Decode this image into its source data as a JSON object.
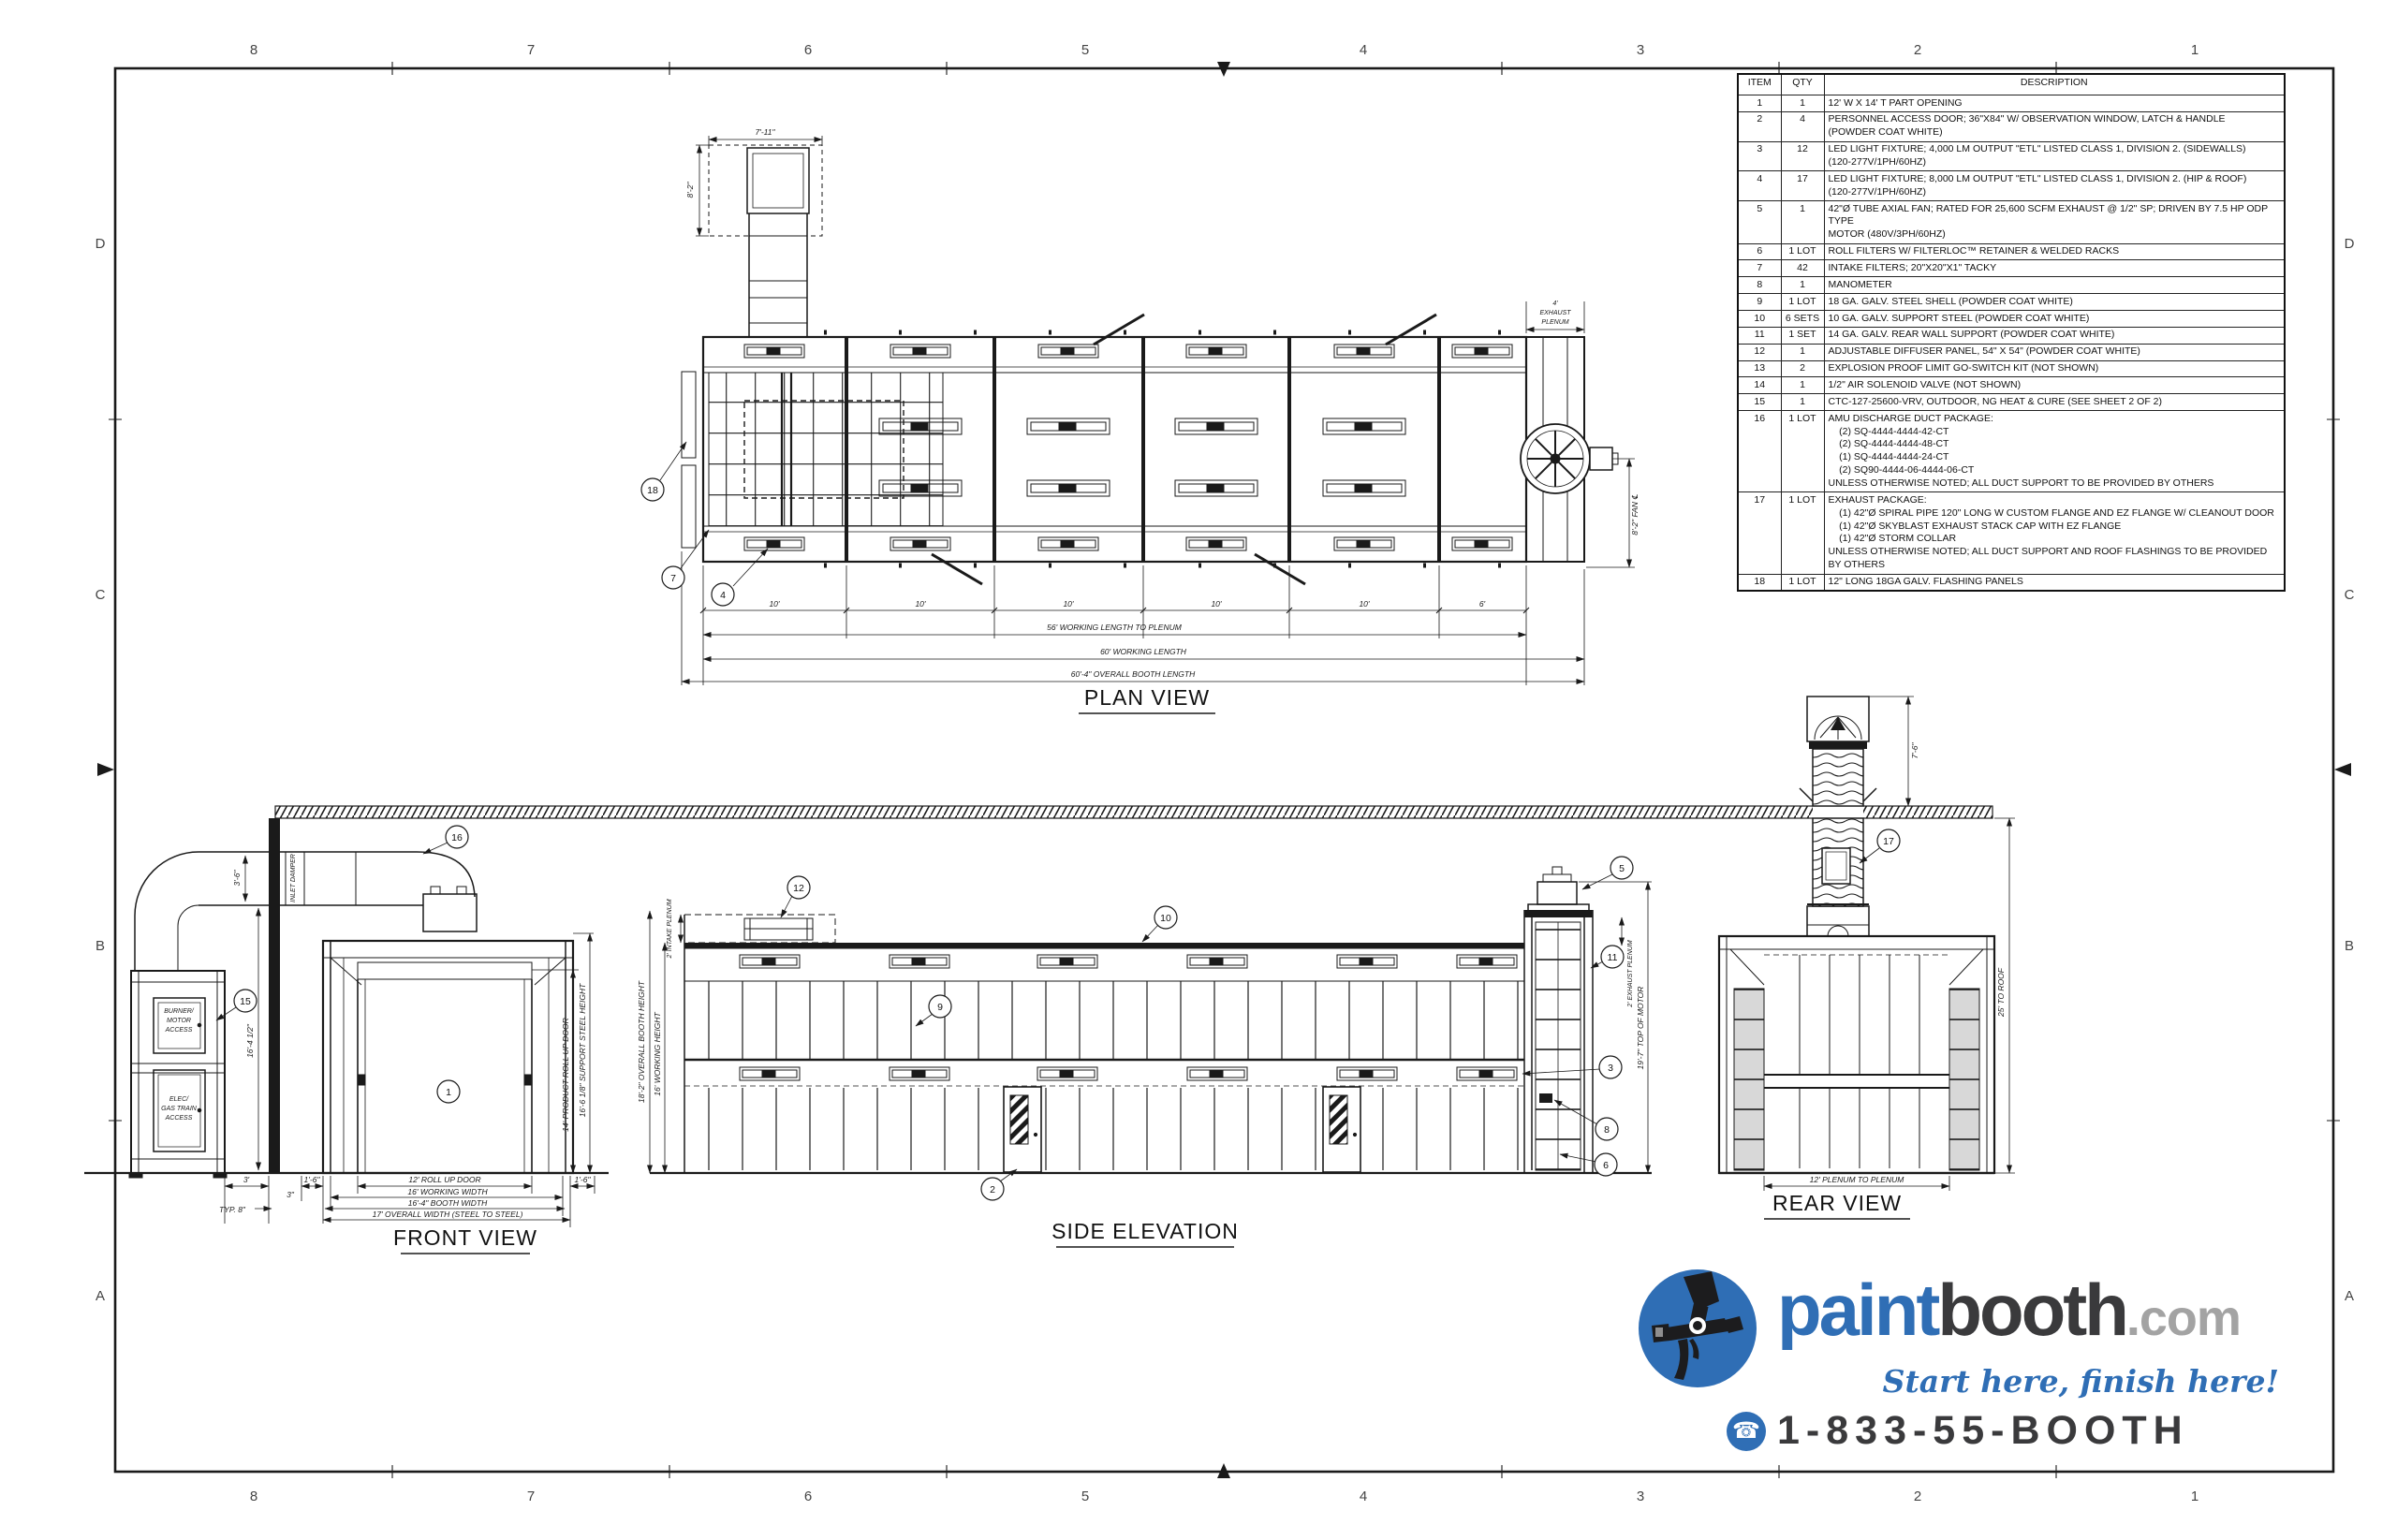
{
  "border": {
    "columns": [
      "8",
      "7",
      "6",
      "5",
      "4",
      "3",
      "2",
      "1"
    ],
    "rows": [
      "D",
      "C",
      "B",
      "A"
    ]
  },
  "parts_table": {
    "headers": {
      "item": "ITEM",
      "qty": "QTY",
      "desc": "DESCRIPTION"
    },
    "rows": [
      {
        "item": "1",
        "qty": "1",
        "desc": "12' W X 14' T PART OPENING"
      },
      {
        "item": "2",
        "qty": "4",
        "desc": "PERSONNEL ACCESS DOOR; 36\"X84\" W/ OBSERVATION WINDOW, LATCH & HANDLE\n(POWDER COAT WHITE)"
      },
      {
        "item": "3",
        "qty": "12",
        "desc": "LED LIGHT FIXTURE; 4,000 LM OUTPUT \"ETL\" LISTED CLASS 1, DIVISION 2. (SIDEWALLS)\n(120-277V/1PH/60HZ)"
      },
      {
        "item": "4",
        "qty": "17",
        "desc": "LED LIGHT FIXTURE; 8,000 LM OUTPUT \"ETL\" LISTED CLASS 1, DIVISION 2. (HIP & ROOF)\n(120-277V/1PH/60HZ)"
      },
      {
        "item": "5",
        "qty": "1",
        "desc": "42\"Ø TUBE AXIAL FAN; RATED FOR 25,600 SCFM EXHAUST @ 1/2\" SP; DRIVEN BY 7.5 HP ODP TYPE\nMOTOR (480V/3PH/60HZ)"
      },
      {
        "item": "6",
        "qty": "1 LOT",
        "desc": "ROLL FILTERS W/ FILTERLOC™ RETAINER & WELDED RACKS"
      },
      {
        "item": "7",
        "qty": "42",
        "desc": "INTAKE FILTERS; 20\"X20\"X1\" TACKY"
      },
      {
        "item": "8",
        "qty": "1",
        "desc": "MANOMETER"
      },
      {
        "item": "9",
        "qty": "1 LOT",
        "desc": "18 GA. GALV. STEEL SHELL (POWDER COAT WHITE)"
      },
      {
        "item": "10",
        "qty": "6 SETS",
        "desc": "10 GA. GALV. SUPPORT STEEL (POWDER COAT WHITE)"
      },
      {
        "item": "11",
        "qty": "1 SET",
        "desc": "14 GA. GALV. REAR WALL SUPPORT (POWDER COAT WHITE)"
      },
      {
        "item": "12",
        "qty": "1",
        "desc": "ADJUSTABLE DIFFUSER PANEL, 54\" X 54\" (POWDER COAT WHITE)"
      },
      {
        "item": "13",
        "qty": "2",
        "desc": "EXPLOSION PROOF LIMIT GO-SWITCH KIT (NOT SHOWN)"
      },
      {
        "item": "14",
        "qty": "1",
        "desc": "1/2\" AIR SOLENOID VALVE (NOT SHOWN)"
      },
      {
        "item": "15",
        "qty": "1",
        "desc": "CTC-127-25600-VRV, OUTDOOR, NG HEAT & CURE (SEE SHEET 2 OF 2)"
      },
      {
        "item": "16",
        "qty": "1 LOT",
        "desc": "AMU DISCHARGE DUCT PACKAGE:\n    (2) SQ-4444-4444-42-CT\n    (2) SQ-4444-4444-48-CT\n    (1) SQ-4444-4444-24-CT\n    (2) SQ90-4444-06-4444-06-CT\nUNLESS OTHERWISE NOTED; ALL DUCT SUPPORT TO BE PROVIDED BY OTHERS"
      },
      {
        "item": "17",
        "qty": "1 LOT",
        "desc": "EXHAUST PACKAGE:\n    (1) 42\"Ø SPIRAL PIPE 120\" LONG W CUSTOM FLANGE AND EZ FLANGE W/ CLEANOUT DOOR\n    (1) 42\"Ø SKYBLAST EXHAUST STACK CAP WITH EZ FLANGE\n    (1) 42\"Ø STORM COLLAR\nUNLESS OTHERWISE NOTED; ALL DUCT SUPPORT AND ROOF FLASHINGS TO BE PROVIDED\nBY OTHERS"
      },
      {
        "item": "18",
        "qty": "1 LOT",
        "desc": "12\" LONG 18GA GALV. FLASHING PANELS"
      }
    ]
  },
  "titles": {
    "plan": "PLAN VIEW",
    "front": "FRONT VIEW",
    "side": "SIDE ELEVATION",
    "rear": "REAR VIEW"
  },
  "plan": {
    "duct_w": "7'-11\"",
    "duct_h": "8'-2\"",
    "plenum_l1": "4'",
    "plenum_l2": "EXHAUST",
    "plenum_l3": "PLENUM",
    "bays": [
      "10'",
      "10'",
      "10'",
      "10'",
      "10'",
      "6'"
    ],
    "len_to_plenum": "56' WORKING LENGTH TO PLENUM",
    "len_working": "60' WORKING LENGTH",
    "len_overall": "60'-4\" OVERALL BOOTH LENGTH",
    "fan_cl": "8'-2\" FAN ℄"
  },
  "front": {
    "amu_door1": [
      "BURNER/",
      "MOTOR",
      "ACCESS"
    ],
    "amu_door2": [
      "ELEC/",
      "GAS TRAIN",
      "ACCESS"
    ],
    "inlet_damper": "INLET DAMPER",
    "duct_rise": "3'-6\"",
    "duct_height": "16'-4 1/2\"",
    "amu_gap": "3'",
    "typ8": "TYP. 8\"",
    "left_16": "1'-6\"",
    "in3": "3\"",
    "door_w": "12' ROLL UP DOOR",
    "working_w": "16' WORKING WIDTH",
    "booth_w": "16'-4\" BOOTH WIDTH",
    "overall_w": "17' OVERALL WIDTH (STEEL TO STEEL)",
    "right_16": "1'-6\"",
    "door_h": "14' PRODUCT ROLL UP DOOR",
    "steel_h": "16'-6 1/8\" SUPPORT STEEL HEIGHT"
  },
  "side": {
    "intake": "2' INTAKE PLENUM",
    "overall_h": "18'-2\" OVERALL BOOTH HEIGHT",
    "working_h": "16' WORKING HEIGHT",
    "exhaust": "2' EXHAUST PLENUM",
    "motor_h": "19'-7\" TOP OF MOTOR"
  },
  "rear": {
    "stack_h": "7'-6\"",
    "roof_h": "25' TO ROOF",
    "plenum_w": "12' PLENUM TO PLENUM"
  },
  "callouts": {
    "plan": [
      "18",
      "7",
      "4"
    ],
    "front": [
      "16",
      "15",
      "1"
    ],
    "side": [
      "12",
      "10",
      "9",
      "2",
      "5",
      "11",
      "3",
      "8",
      "6"
    ],
    "rear": [
      "17"
    ]
  },
  "logo": {
    "word1": "paint",
    "word2": "booth",
    "word3": ".com",
    "tagline": "Start here, finish here!",
    "phone": "1-833-55-BOOTH",
    "blue": "#2f6eb5",
    "dark": "#3a3a3c",
    "gray": "#a3a3a3"
  }
}
